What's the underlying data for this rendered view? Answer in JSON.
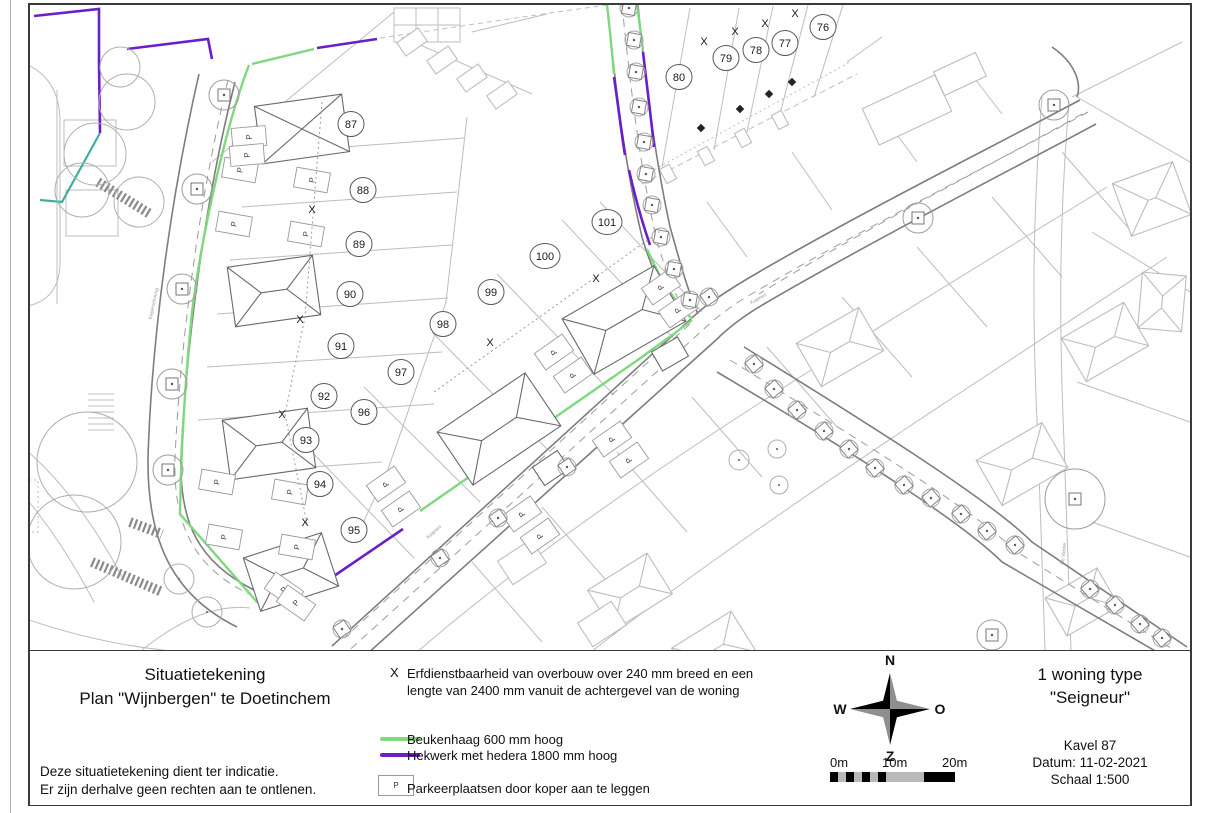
{
  "title_block": {
    "line1": "Situatietekening",
    "line2": "Plan \"Wijnbergen\" te  Doetinchem",
    "disclaimer1": "Deze situatietekening dient ter indicatie.",
    "disclaimer2": "Er zijn derhalve geen rechten aan te ontlenen."
  },
  "legend": {
    "x_symbol": "X",
    "x_line1": "Erfdienstbaarheid van overbouw over 240 mm breed en een",
    "x_line2": "lengte van 2400 mm vanuit de achtergevel van de woning",
    "hedge_label": "Beukenhaag 600 mm hoog",
    "fence_label": "Hekwerk met hedera 1800 mm hoog",
    "p_symbol": "P",
    "p_label": "Parkeerplaatsen door koper aan te leggen",
    "hedge_color": "#7ed87e",
    "fence_color": "#6a1fc8"
  },
  "compass": {
    "north": "N",
    "east": "O",
    "south": "Z",
    "west": "W"
  },
  "scalebar": {
    "label_0": "0m",
    "label_10": "10m",
    "label_20": "20m"
  },
  "info_block": {
    "type_line1": "1 woning type",
    "type_line2": "\"Seigneur\"",
    "kavel": "Kavel 87",
    "datum": "Datum: 11-02-2021",
    "schaal": "Schaal 1:500"
  },
  "map": {
    "plots": [
      {
        "label": "76",
        "x": 821,
        "y": 25
      },
      {
        "label": "77",
        "x": 783,
        "y": 41
      },
      {
        "label": "78",
        "x": 754,
        "y": 48
      },
      {
        "label": "79",
        "x": 724,
        "y": 56
      },
      {
        "label": "80",
        "x": 677,
        "y": 75
      },
      {
        "label": "87",
        "x": 349,
        "y": 122
      },
      {
        "label": "88",
        "x": 361,
        "y": 188
      },
      {
        "label": "89",
        "x": 357,
        "y": 242
      },
      {
        "label": "90",
        "x": 348,
        "y": 292
      },
      {
        "label": "91",
        "x": 339,
        "y": 344
      },
      {
        "label": "92",
        "x": 322,
        "y": 394
      },
      {
        "label": "93",
        "x": 304,
        "y": 438
      },
      {
        "label": "94",
        "x": 318,
        "y": 482
      },
      {
        "label": "95",
        "x": 352,
        "y": 528
      },
      {
        "label": "96",
        "x": 362,
        "y": 410
      },
      {
        "label": "97",
        "x": 399,
        "y": 370
      },
      {
        "label": "98",
        "x": 441,
        "y": 322
      },
      {
        "label": "99",
        "x": 489,
        "y": 290
      },
      {
        "label": "100",
        "x": 543,
        "y": 254
      },
      {
        "label": "101",
        "x": 605,
        "y": 220
      }
    ],
    "x_marks": [
      {
        "x": 310,
        "y": 207
      },
      {
        "x": 298,
        "y": 317
      },
      {
        "x": 280,
        "y": 412
      },
      {
        "x": 303,
        "y": 520
      },
      {
        "x": 488,
        "y": 340
      },
      {
        "x": 594,
        "y": 276
      },
      {
        "x": 702,
        "y": 39
      },
      {
        "x": 733,
        "y": 29
      },
      {
        "x": 763,
        "y": 21
      },
      {
        "x": 793,
        "y": 11
      }
    ],
    "p_marks": [
      {
        "x": 238,
        "y": 168,
        "r": -80
      },
      {
        "x": 310,
        "y": 178,
        "r": -80
      },
      {
        "x": 232,
        "y": 222,
        "r": -80
      },
      {
        "x": 304,
        "y": 232,
        "r": -80
      },
      {
        "x": 215,
        "y": 480,
        "r": -80
      },
      {
        "x": 288,
        "y": 490,
        "r": -80
      },
      {
        "x": 222,
        "y": 535,
        "r": -80
      },
      {
        "x": 295,
        "y": 545,
        "r": -80
      },
      {
        "x": 282,
        "y": 588,
        "r": -55
      },
      {
        "x": 294,
        "y": 601,
        "r": -55
      },
      {
        "x": 384,
        "y": 482,
        "r": -125
      },
      {
        "x": 399,
        "y": 507,
        "r": -125
      },
      {
        "x": 552,
        "y": 350,
        "r": -125
      },
      {
        "x": 571,
        "y": 373,
        "r": -125
      },
      {
        "x": 659,
        "y": 285,
        "r": -125
      },
      {
        "x": 676,
        "y": 308,
        "r": -125
      },
      {
        "x": 520,
        "y": 512,
        "r": -125
      },
      {
        "x": 538,
        "y": 534,
        "r": -125
      },
      {
        "x": 610,
        "y": 437,
        "r": -125
      },
      {
        "x": 627,
        "y": 458,
        "r": -125
      },
      {
        "x": 247,
        "y": 135,
        "r": -95
      },
      {
        "x": 245,
        "y": 153,
        "r": -95
      }
    ],
    "street_labels": [
      {
        "text": "Kepersbinning",
        "x": 153,
        "y": 302,
        "r": -78
      },
      {
        "text": "Kuipnes",
        "x": 757,
        "y": 298,
        "r": -30
      },
      {
        "text": "Kuipnes",
        "x": 433,
        "y": 531,
        "r": -42
      },
      {
        "text": "De Vanne",
        "x": 1063,
        "y": 552,
        "r": -84
      }
    ],
    "tree_squares": [
      {
        "x": 340,
        "y": 627,
        "r": -34
      },
      {
        "x": 438,
        "y": 556,
        "r": -34
      },
      {
        "x": 496,
        "y": 516,
        "r": -34
      },
      {
        "x": 565,
        "y": 465,
        "r": -34
      },
      {
        "x": 707,
        "y": 295,
        "r": -34
      },
      {
        "x": 627,
        "y": 6,
        "r": -80
      },
      {
        "x": 632,
        "y": 38,
        "r": -80
      },
      {
        "x": 634,
        "y": 70,
        "r": -80
      },
      {
        "x": 637,
        "y": 105,
        "r": -80
      },
      {
        "x": 642,
        "y": 140,
        "r": -80
      },
      {
        "x": 644,
        "y": 172,
        "r": -80
      },
      {
        "x": 650,
        "y": 203,
        "r": -80
      },
      {
        "x": 659,
        "y": 235,
        "r": -80
      },
      {
        "x": 672,
        "y": 267,
        "r": -80
      },
      {
        "x": 688,
        "y": 298,
        "r": -80
      },
      {
        "x": 752,
        "y": 362,
        "r": -40
      },
      {
        "x": 772,
        "y": 387,
        "r": -40
      },
      {
        "x": 795,
        "y": 408,
        "r": -40
      },
      {
        "x": 822,
        "y": 429,
        "r": -40
      },
      {
        "x": 847,
        "y": 447,
        "r": -40
      },
      {
        "x": 873,
        "y": 466,
        "r": -40
      },
      {
        "x": 902,
        "y": 483,
        "r": -40
      },
      {
        "x": 929,
        "y": 496,
        "r": -40
      },
      {
        "x": 959,
        "y": 512,
        "r": -40
      },
      {
        "x": 985,
        "y": 529,
        "r": -40
      },
      {
        "x": 1013,
        "y": 543,
        "r": -40
      },
      {
        "x": 1088,
        "y": 587,
        "r": -40
      },
      {
        "x": 1113,
        "y": 603,
        "r": -40
      },
      {
        "x": 1138,
        "y": 622,
        "r": -40
      },
      {
        "x": 1160,
        "y": 636,
        "r": -40
      }
    ],
    "lamps": [
      {
        "x": 222,
        "y": 93
      },
      {
        "x": 195,
        "y": 187
      },
      {
        "x": 180,
        "y": 287
      },
      {
        "x": 170,
        "y": 382
      },
      {
        "x": 166,
        "y": 468
      },
      {
        "x": 1052,
        "y": 103
      },
      {
        "x": 916,
        "y": 216
      },
      {
        "x": 990,
        "y": 633
      },
      {
        "x": 1073,
        "y": 497,
        "big": true
      }
    ],
    "bushes": [
      {
        "x": 737,
        "y": 458,
        "rad": 10
      },
      {
        "x": 775,
        "y": 447,
        "rad": 9
      },
      {
        "x": 777,
        "y": 483,
        "rad": 9
      },
      {
        "x": 118,
        "y": 65,
        "rad": 20
      },
      {
        "x": 125,
        "y": 100,
        "rad": 28
      },
      {
        "x": 93,
        "y": 152,
        "rad": 31
      },
      {
        "x": 80,
        "y": 188,
        "rad": 27
      },
      {
        "x": 137,
        "y": 200,
        "rad": 25
      },
      {
        "x": 85,
        "y": 460,
        "rad": 50
      },
      {
        "x": 72,
        "y": 540,
        "rad": 47
      },
      {
        "x": 177,
        "y": 577,
        "rad": 15
      },
      {
        "x": 205,
        "y": 610,
        "rad": 15
      }
    ],
    "bollards": [
      {
        "x": 699,
        "y": 126
      },
      {
        "x": 738,
        "y": 107
      },
      {
        "x": 767,
        "y": 92
      },
      {
        "x": 790,
        "y": 80
      }
    ]
  }
}
